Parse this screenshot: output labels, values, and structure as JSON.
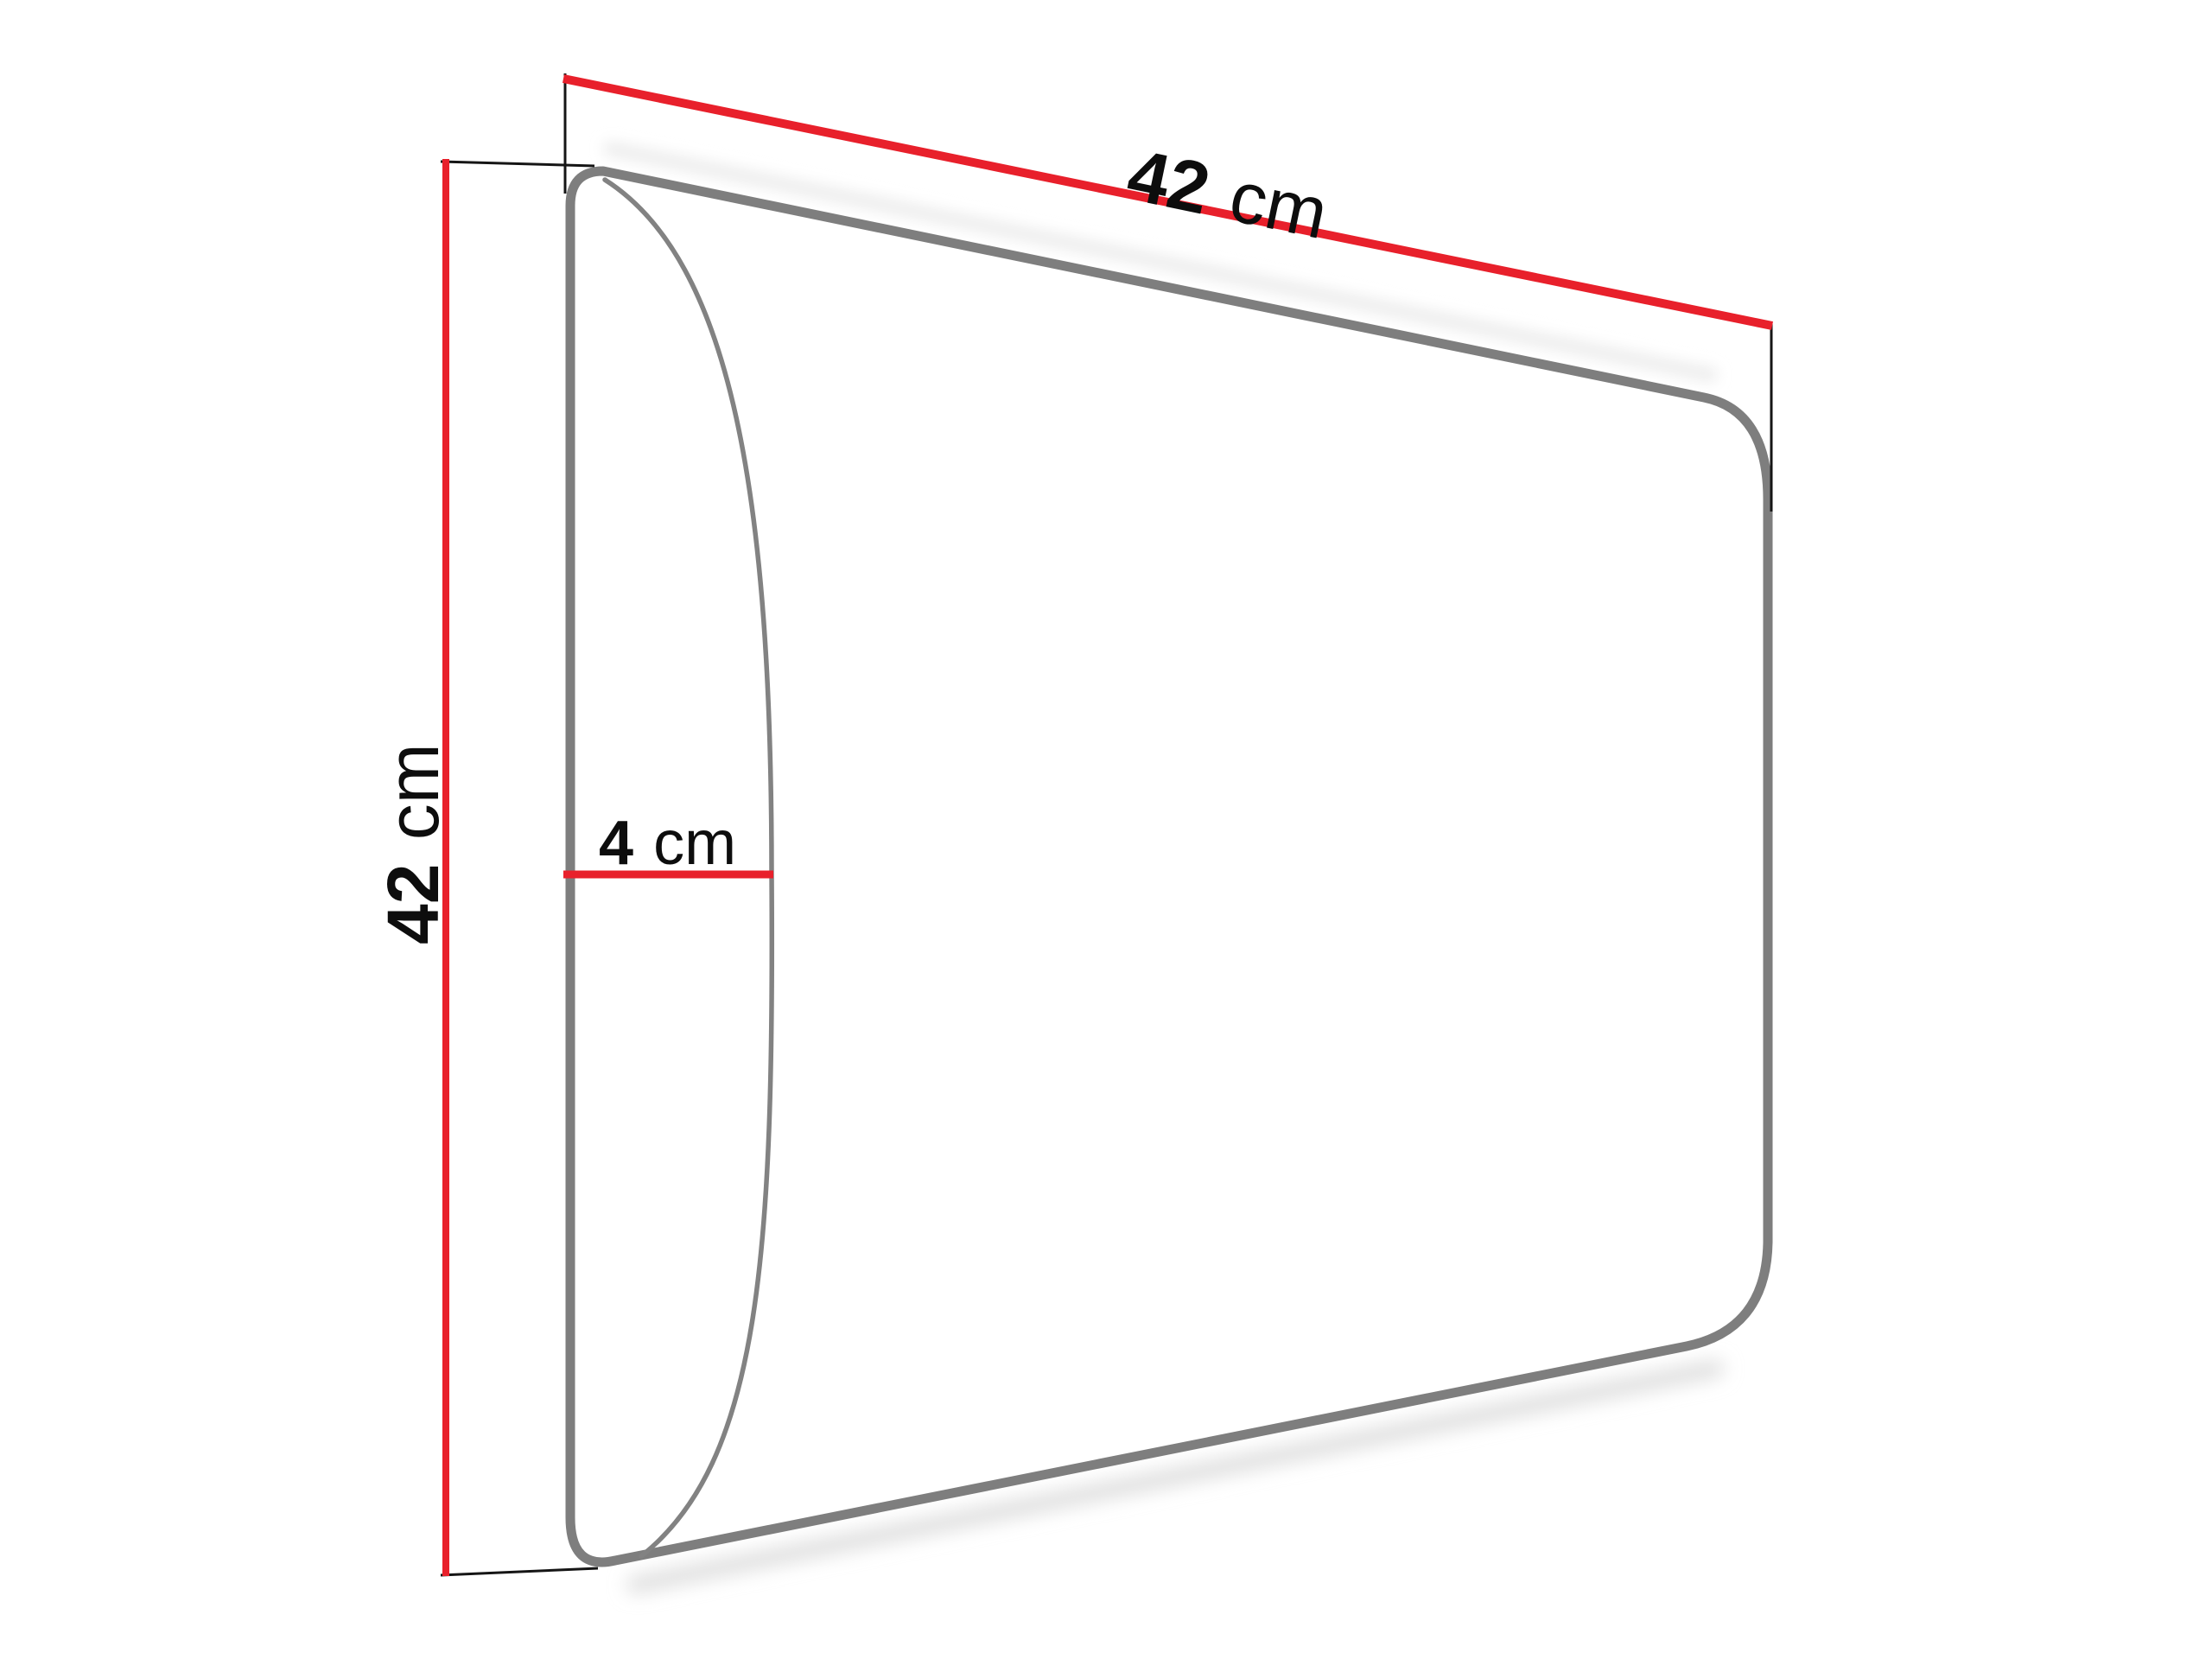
{
  "diagram": {
    "kind": "product-dimension-diagram",
    "subject": "upholstered-wall-panel-perspective-view",
    "width_label": {
      "value": "42",
      "unit": "cm"
    },
    "height_label": {
      "value": "42",
      "unit": "cm"
    },
    "depth_label": {
      "value": "4",
      "unit": "cm"
    },
    "colors": {
      "dimension_line": "#e8202b",
      "panel_outline": "#7e7e7e",
      "front_edge_curve": "#828282",
      "extension_line": "#151515",
      "label_text": "#0d0d0d",
      "background": "#ffffff"
    }
  }
}
